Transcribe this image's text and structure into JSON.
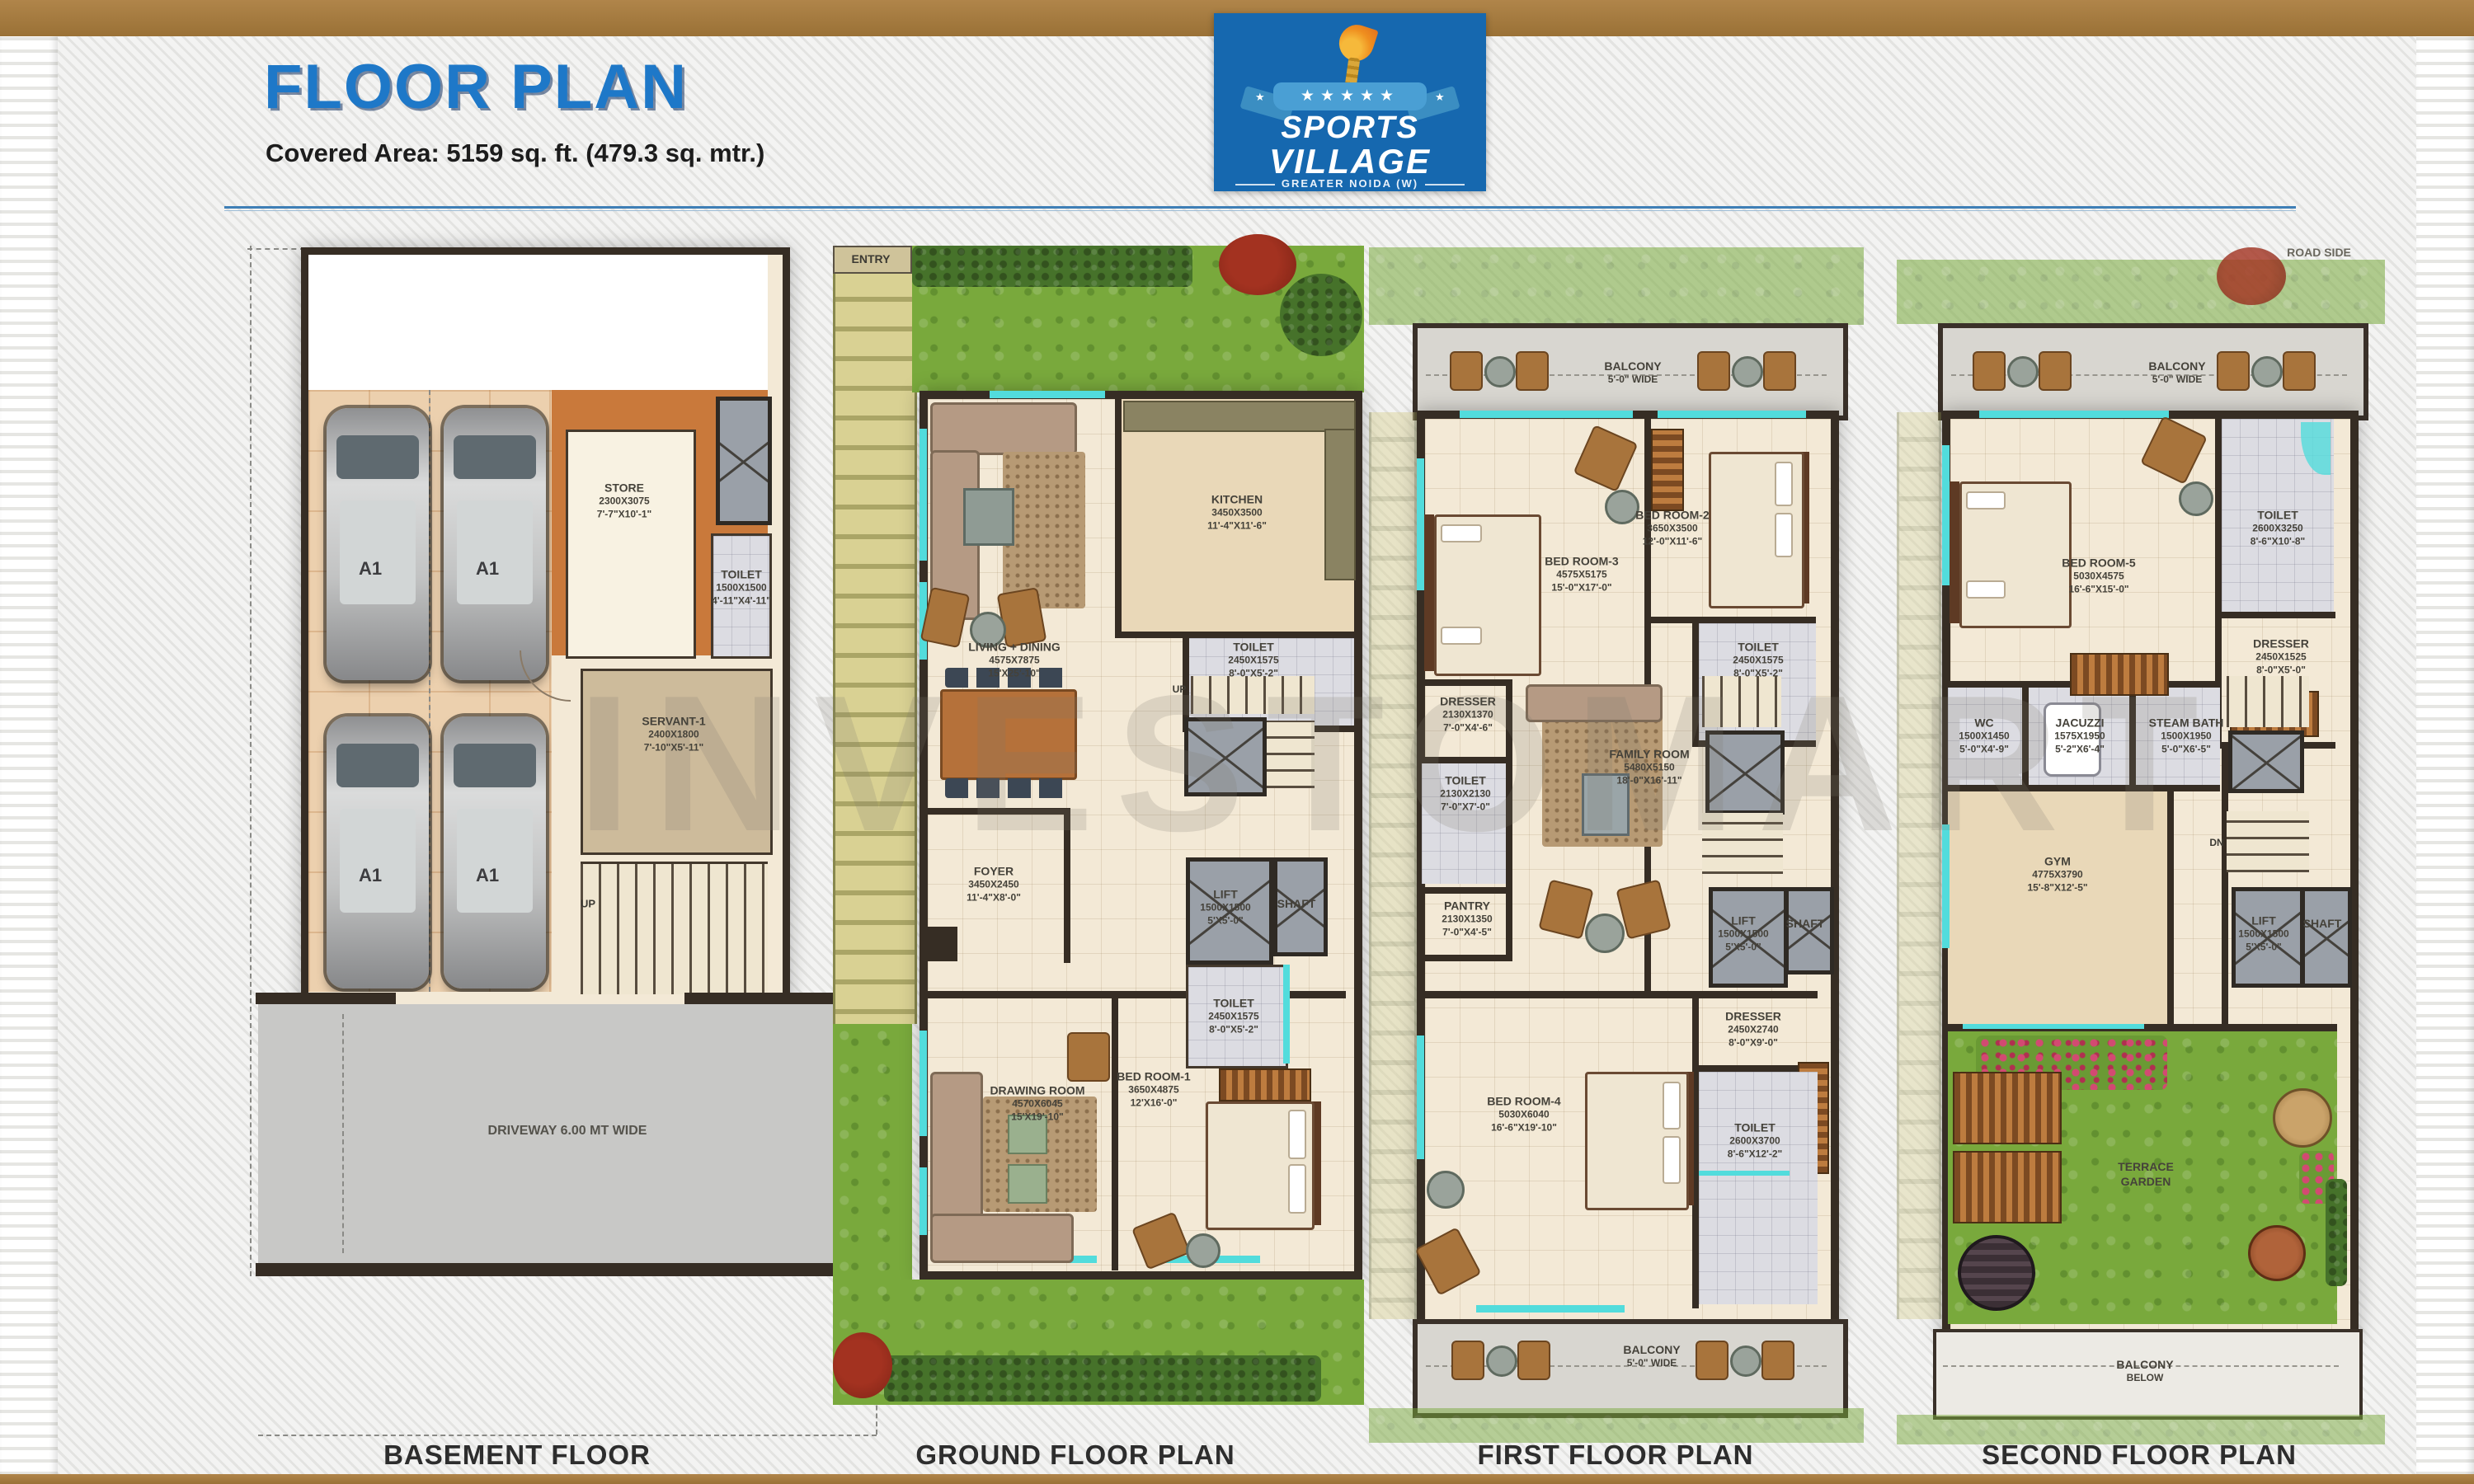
{
  "header": {
    "title": "FLOOR PLAN",
    "covered_area": "Covered Area: 5159 sq. ft. (479.3 sq. mtr.)"
  },
  "logo": {
    "line1": "SPORTS",
    "line2": "VILLAGE",
    "tagline": "GREATER NOIDA (W)",
    "stars": "★★★★★",
    "side_star": "★",
    "bg_color": "#1668af"
  },
  "watermark": "INVESTOMART",
  "misc": {
    "entry": "ENTRY",
    "road_side": "ROAD SIDE",
    "up": "UP",
    "dn": "DN",
    "car_plate": "A1"
  },
  "colors": {
    "title_blue": "#1e78c8",
    "frame_brown": "#a87c3e",
    "wall": "#362d24",
    "window_teal": "#52dcdc",
    "grass_green": "#79a93c"
  },
  "basement": {
    "label": "BASEMENT FLOOR",
    "driveway": "DRIVEWAY 6.00 MT WIDE",
    "rooms": {
      "store": {
        "name": "STORE",
        "mm": "2300X3075",
        "ft": "7'-7\"X10'-1\""
      },
      "toilet": {
        "name": "TOILET",
        "mm": "1500X1500",
        "ft": "4'-11\"X4'-11\""
      },
      "servant": {
        "name": "SERVANT-1",
        "mm": "2400X1800",
        "ft": "7'-10\"X5'-11\""
      }
    }
  },
  "ground": {
    "label": "GROUND FLOOR PLAN",
    "rooms": {
      "living": {
        "name": "LIVING + DINING",
        "mm": "4575X7875",
        "ft": "15'X25'-10\""
      },
      "kitchen": {
        "name": "KITCHEN",
        "mm": "3450X3500",
        "ft": "11'-4\"X11'-6\""
      },
      "toilet1": {
        "name": "TOILET",
        "mm": "2450X1575",
        "ft": "8'-0\"X5'-2\""
      },
      "foyer": {
        "name": "FOYER",
        "mm": "3450X2450",
        "ft": "11'-4\"X8'-0\""
      },
      "lift": {
        "name": "LIFT",
        "mm": "1500X1500",
        "ft": "5'X5'-0\""
      },
      "shaft": {
        "name": "SHAFT"
      },
      "toilet2": {
        "name": "TOILET",
        "mm": "2450X1575",
        "ft": "8'-0\"X5'-2\""
      },
      "drawing": {
        "name": "DRAWING ROOM",
        "mm": "4570X6045",
        "ft": "15'X19'-10\""
      },
      "bed1": {
        "name": "BED ROOM-1",
        "mm": "3650X4875",
        "ft": "12'X16'-0\""
      }
    }
  },
  "first": {
    "label": "FIRST FLOOR PLAN",
    "balcony_top": {
      "name": "BALCONY",
      "ft": "5'-0\" WIDE"
    },
    "balcony_bottom": {
      "name": "BALCONY",
      "ft": "5'-0\" WIDE"
    },
    "rooms": {
      "bed3": {
        "name": "BED ROOM-3",
        "mm": "4575X5175",
        "ft": "15'-0\"X17'-0\""
      },
      "bed2": {
        "name": "BED ROOM-2",
        "mm": "3650X3500",
        "ft": "12'-0\"X11'-6\""
      },
      "toilet_a": {
        "name": "TOILET",
        "mm": "2450X1575",
        "ft": "8'-0\"X5'-2\""
      },
      "dresser_a": {
        "name": "DRESSER",
        "mm": "2130X1370",
        "ft": "7'-0\"X4'-6\""
      },
      "toilet_b": {
        "name": "TOILET",
        "mm": "2130X2130",
        "ft": "7'-0\"X7'-0\""
      },
      "pantry": {
        "name": "PANTRY",
        "mm": "2130X1350",
        "ft": "7'-0\"X4'-5\""
      },
      "family": {
        "name": "FAMILY ROOM",
        "mm": "5480X5150",
        "ft": "18'-0\"X16'-11\""
      },
      "lift": {
        "name": "LIFT",
        "mm": "1500X1500",
        "ft": "5'X5'-0\""
      },
      "shaft": {
        "name": "SHAFT"
      },
      "dresser_b": {
        "name": "DRESSER",
        "mm": "2450X2740",
        "ft": "8'-0\"X9'-0\""
      },
      "bed4": {
        "name": "BED ROOM-4",
        "mm": "5030X6040",
        "ft": "16'-6\"X19'-10\""
      },
      "toilet_c": {
        "name": "TOILET",
        "mm": "2600X3700",
        "ft": "8'-6\"X12'-2\""
      }
    }
  },
  "second": {
    "label": "SECOND FLOOR PLAN",
    "balcony_top": {
      "name": "BALCONY",
      "ft": "5'-0\" WIDE"
    },
    "balcony_below": {
      "name": "BALCONY",
      "ft": "BELOW"
    },
    "terrace": {
      "line1": "TERRACE",
      "line2": "GARDEN"
    },
    "rooms": {
      "bed5": {
        "name": "BED ROOM-5",
        "mm": "5030X4575",
        "ft": "16'-6\"X15'-0\""
      },
      "toilet": {
        "name": "TOILET",
        "mm": "2600X3250",
        "ft": "8'-6\"X10'-8\""
      },
      "dresser": {
        "name": "DRESSER",
        "mm": "2450X1525",
        "ft": "8'-0\"X5'-0\""
      },
      "wc": {
        "name": "WC",
        "mm": "1500X1450",
        "ft": "5'-0\"X4'-9\""
      },
      "jacuzzi": {
        "name": "JACUZZI",
        "mm": "1575X1950",
        "ft": "5'-2\"X6'-4\""
      },
      "steam": {
        "name": "STEAM BATH",
        "mm": "1500X1950",
        "ft": "5'-0\"X6'-5\""
      },
      "gym": {
        "name": "GYM",
        "mm": "4775X3790",
        "ft": "15'-8\"X12'-5\""
      },
      "lift": {
        "name": "LIFT",
        "mm": "1500X1500",
        "ft": "5'X5'-0\""
      },
      "shaft": {
        "name": "SHAFT"
      }
    }
  }
}
